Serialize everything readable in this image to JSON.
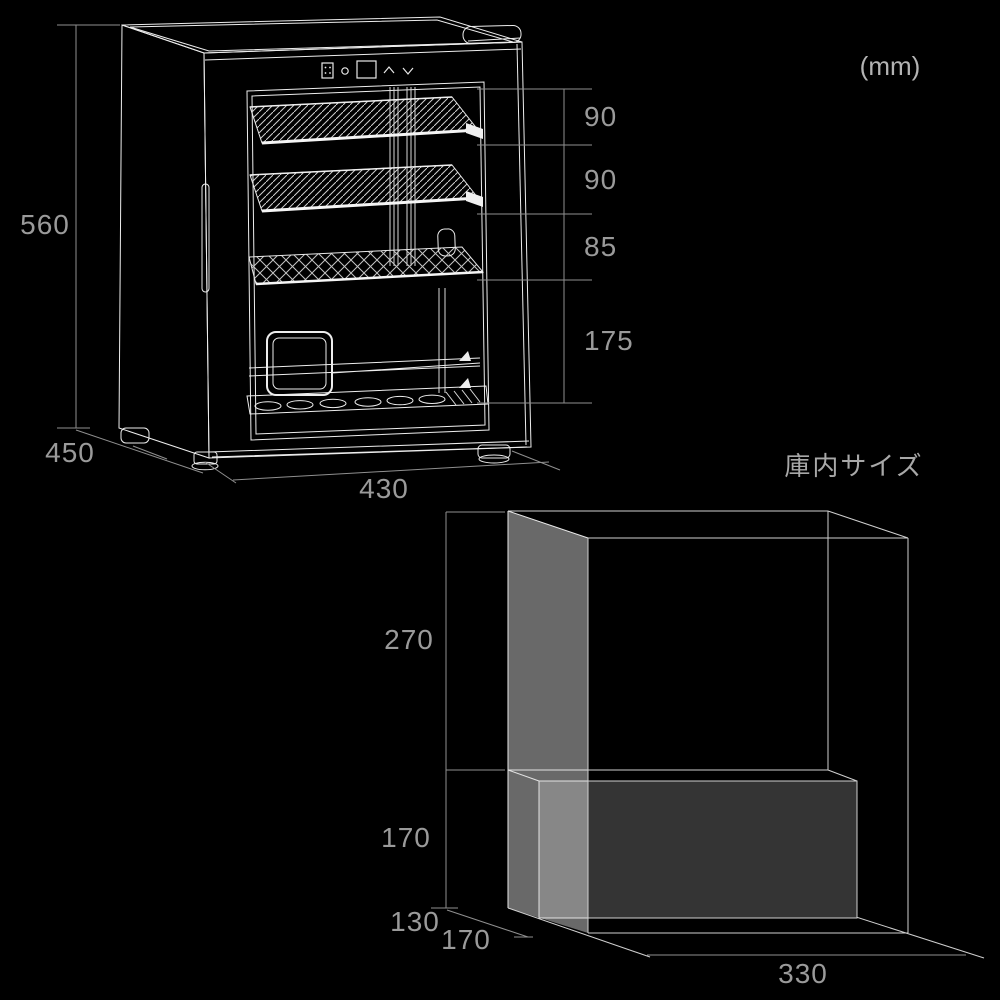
{
  "unit_label": "(mm)",
  "exterior_dimensions": {
    "height_mm": "560",
    "depth_mm": "450",
    "width_mm": "430",
    "shelf_spacing_mm": [
      "90",
      "90",
      "85",
      "175"
    ]
  },
  "interior_dimensions": {
    "title": "庫内サイズ",
    "upper_height_mm": "270",
    "lower_height_mm": "170",
    "depth_back_mm": "130",
    "depth_front_mm": "170",
    "width_mm": "330"
  },
  "control_panel_icons": [
    "shelf-grid-icon",
    "power-icon",
    "display-panel",
    "up-chevron-icon",
    "down-chevron-icon"
  ],
  "colors": {
    "background": "#000000",
    "product_line": "#ededed",
    "dimension_line": "#8f8f8f",
    "dimension_text": "#9a9a9a",
    "unit_text": "#b3b3b3",
    "title_text": "#a8a8a8",
    "interior_wall_overlay": "rgba(255,255,255,0.41)",
    "interior_lower_box": "#343434"
  }
}
